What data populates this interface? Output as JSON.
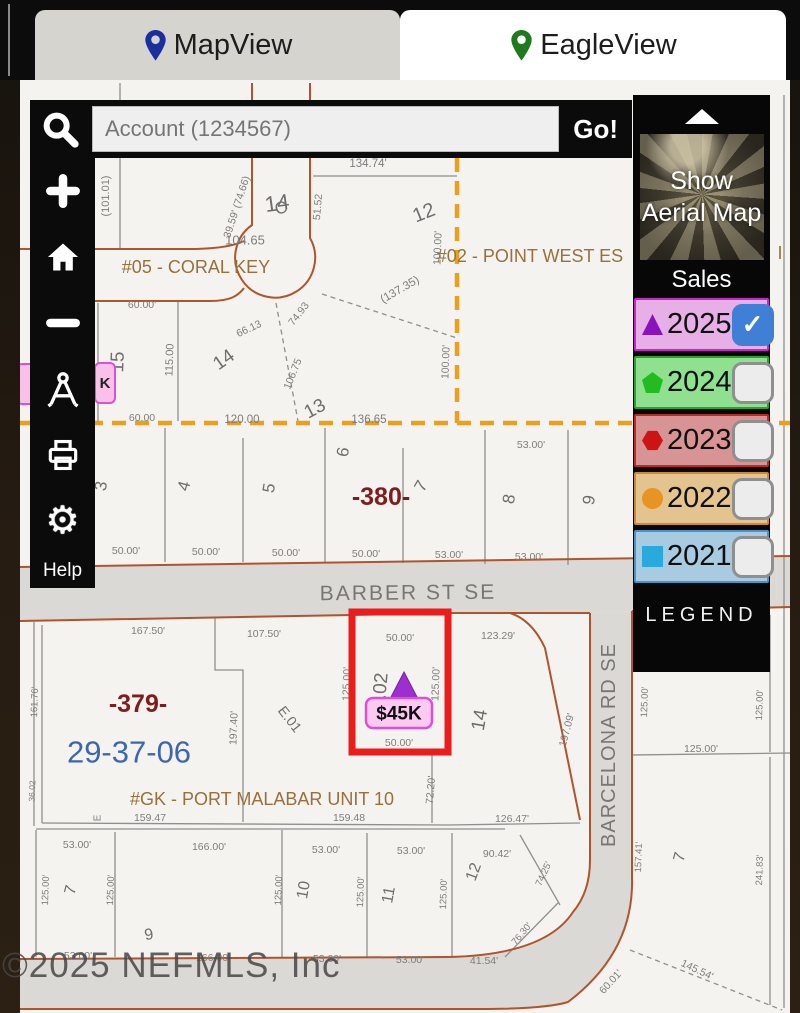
{
  "tabs": {
    "mapview": "MapView",
    "eagleview": "EagleView"
  },
  "search": {
    "placeholder": "Account (1234567)",
    "go": "Go!"
  },
  "toolbar": {
    "help": "Help"
  },
  "icons": {
    "tabs": [
      "map-pin-blue",
      "map-pin-green"
    ],
    "toolbar": [
      "search",
      "zoom-in",
      "home",
      "zoom-out",
      "measure",
      "print",
      "settings"
    ],
    "panel": [
      "collapse-up"
    ]
  },
  "panel": {
    "aerial": "Show Aerial Map",
    "sales": "Sales",
    "legend": "LEGEND",
    "years": [
      {
        "label": "2025",
        "bg": "#e6b0e6",
        "border": "#cc22cc",
        "icon": "triangle",
        "icon_color": "#8812bb",
        "checked": true
      },
      {
        "label": "2024",
        "bg": "#8fe08f",
        "border": "#2f9f2f",
        "icon": "pentagon",
        "icon_color": "#22bb22",
        "checked": false
      },
      {
        "label": "2023",
        "bg": "#d89494",
        "border": "#bb2929",
        "icon": "hexagon",
        "icon_color": "#cc1414",
        "checked": false
      },
      {
        "label": "2022",
        "bg": "#e4c48e",
        "border": "#cc8833",
        "icon": "circle",
        "icon_color": "#e89424",
        "checked": false
      },
      {
        "label": "2021",
        "bg": "#a8cbe2",
        "border": "#4a94c4",
        "icon": "square",
        "icon_color": "#28aadc",
        "checked": false
      }
    ]
  },
  "map": {
    "watermark": "©2025 NEFMLS, Inc",
    "badge": "$45K",
    "hidden_marker": "K",
    "labels": [
      {
        "t": "(101.01)",
        "x": 106,
        "y": 196,
        "r": -90,
        "s": 11,
        "c": "d"
      },
      {
        "t": "14",
        "x": 277,
        "y": 203,
        "r": -8,
        "s": 22,
        "c": "l"
      },
      {
        "t": "104.65",
        "x": 245,
        "y": 240,
        "r": 0,
        "s": 13,
        "c": "d"
      },
      {
        "t": "39.59' (74.66)",
        "x": 237,
        "y": 207,
        "r": -72,
        "s": 10.5,
        "c": "d"
      },
      {
        "t": "C",
        "x": 281,
        "y": 208,
        "r": -15,
        "s": 17,
        "c": "l"
      },
      {
        "t": "134.74'",
        "x": 368,
        "y": 164,
        "r": 0,
        "s": 11.5,
        "c": "d"
      },
      {
        "t": "51.52",
        "x": 318,
        "y": 207,
        "r": -85,
        "s": 10.5,
        "c": "d"
      },
      {
        "t": "12",
        "x": 424,
        "y": 213,
        "r": -22,
        "s": 20,
        "c": "l"
      },
      {
        "t": "(137.35)",
        "x": 400,
        "y": 290,
        "r": -30,
        "s": 11.5,
        "c": "d"
      },
      {
        "t": "100.00'",
        "x": 438,
        "y": 248,
        "r": -88,
        "s": 10.5,
        "c": "d"
      },
      {
        "t": "100.00'",
        "x": 446,
        "y": 362,
        "r": -88,
        "s": 10.5,
        "c": "d"
      },
      {
        "t": "#05 - CORAL KEY",
        "x": 196,
        "y": 267,
        "r": 0,
        "s": 18,
        "c": "b"
      },
      {
        "t": "#02 - POINT WEST ES",
        "x": 530,
        "y": 256,
        "r": 0,
        "s": 18,
        "c": "b"
      },
      {
        "t": "I",
        "x": 780,
        "y": 253,
        "r": 0,
        "s": 18,
        "c": "b"
      },
      {
        "t": "60.00'",
        "x": 142,
        "y": 305,
        "r": 0,
        "s": 10.5,
        "c": "d"
      },
      {
        "t": "15",
        "x": 118,
        "y": 362,
        "r": -88,
        "s": 19,
        "c": "l"
      },
      {
        "t": "115.00",
        "x": 170,
        "y": 360,
        "r": -88,
        "s": 11,
        "c": "d"
      },
      {
        "t": "14",
        "x": 224,
        "y": 360,
        "r": -35,
        "s": 19,
        "c": "l"
      },
      {
        "t": "66.13",
        "x": 249,
        "y": 329,
        "r": -25,
        "s": 10.5,
        "c": "d"
      },
      {
        "t": "74.93",
        "x": 299,
        "y": 314,
        "r": -52,
        "s": 10.5,
        "c": "d"
      },
      {
        "t": "106.75",
        "x": 293,
        "y": 374,
        "r": -68,
        "s": 10.5,
        "c": "d"
      },
      {
        "t": "13",
        "x": 315,
        "y": 409,
        "r": -28,
        "s": 19,
        "c": "l"
      },
      {
        "t": "60.00",
        "x": 142,
        "y": 418,
        "r": 0,
        "s": 10.5,
        "c": "d"
      },
      {
        "t": "120.00",
        "x": 242,
        "y": 420,
        "r": 0,
        "s": 11.5,
        "c": "d"
      },
      {
        "t": "136.65",
        "x": 369,
        "y": 420,
        "r": 0,
        "s": 11.5,
        "c": "d"
      },
      {
        "t": "3",
        "x": 101,
        "y": 486,
        "r": -80,
        "s": 17,
        "c": "l"
      },
      {
        "t": "4",
        "x": 184,
        "y": 486,
        "r": -75,
        "s": 17,
        "c": "l"
      },
      {
        "t": "5",
        "x": 269,
        "y": 488,
        "r": -80,
        "s": 17,
        "c": "l"
      },
      {
        "t": "6",
        "x": 343,
        "y": 452,
        "r": -80,
        "s": 17,
        "c": "l"
      },
      {
        "t": "-380-",
        "x": 381,
        "y": 497,
        "r": 0,
        "s": 25,
        "c": "r"
      },
      {
        "t": "7",
        "x": 421,
        "y": 486,
        "r": -60,
        "s": 17,
        "c": "l"
      },
      {
        "t": "8",
        "x": 509,
        "y": 499,
        "r": -80,
        "s": 17,
        "c": "l"
      },
      {
        "t": "9",
        "x": 589,
        "y": 500,
        "r": -80,
        "s": 17,
        "c": "l"
      },
      {
        "t": "53.00'",
        "x": 531,
        "y": 445,
        "r": 0,
        "s": 10.5,
        "c": "d"
      },
      {
        "t": "50.00'",
        "x": 126,
        "y": 551,
        "r": 0,
        "s": 10.5,
        "c": "d"
      },
      {
        "t": "50.00'",
        "x": 206,
        "y": 552,
        "r": 0,
        "s": 10.5,
        "c": "d"
      },
      {
        "t": "50.00'",
        "x": 286,
        "y": 553,
        "r": 0,
        "s": 10.5,
        "c": "d"
      },
      {
        "t": "50.00'",
        "x": 366,
        "y": 554,
        "r": 0,
        "s": 10.5,
        "c": "d"
      },
      {
        "t": "53.00'",
        "x": 449,
        "y": 555,
        "r": 0,
        "s": 10.5,
        "c": "d"
      },
      {
        "t": "53.00'",
        "x": 529,
        "y": 557,
        "r": 0,
        "s": 10.5,
        "c": "d"
      },
      {
        "t": "BARBER ST SE",
        "x": 408,
        "y": 593,
        "r": -0.5,
        "s": 21,
        "c": "s",
        "ls": 2
      },
      {
        "t": "167.50'",
        "x": 148,
        "y": 631,
        "r": 0,
        "s": 10.5,
        "c": "d"
      },
      {
        "t": "107.50'",
        "x": 264,
        "y": 634,
        "r": 0,
        "s": 10.5,
        "c": "d"
      },
      {
        "t": "50.00'",
        "x": 400,
        "y": 638,
        "r": 0,
        "s": 10.5,
        "c": "d"
      },
      {
        "t": "123.29'",
        "x": 498,
        "y": 636,
        "r": 0,
        "s": 10.5,
        "c": "d"
      },
      {
        "t": "125.00'",
        "x": 347,
        "y": 684,
        "r": -88,
        "s": 10.5,
        "c": "d"
      },
      {
        "t": ".02",
        "x": 381,
        "y": 686,
        "r": -85,
        "s": 19,
        "c": "l"
      },
      {
        "t": "125.00'",
        "x": 436,
        "y": 684,
        "r": -88,
        "s": 10.5,
        "c": "d"
      },
      {
        "t": "50.00'",
        "x": 399,
        "y": 743,
        "r": 0,
        "s": 10.5,
        "c": "d"
      },
      {
        "t": "14",
        "x": 480,
        "y": 720,
        "r": -80,
        "s": 19,
        "c": "l"
      },
      {
        "t": "197.09'",
        "x": 567,
        "y": 730,
        "r": -75,
        "s": 10.5,
        "c": "d"
      },
      {
        "t": "-379-",
        "x": 138,
        "y": 704,
        "r": 0,
        "s": 25,
        "c": "r"
      },
      {
        "t": "29-37-06",
        "x": 129,
        "y": 752,
        "r": 0,
        "s": 31,
        "c": "u"
      },
      {
        "t": "197.40'",
        "x": 234,
        "y": 728,
        "r": -88,
        "s": 10.5,
        "c": "d"
      },
      {
        "t": "E.01",
        "x": 290,
        "y": 719,
        "r": 52,
        "s": 14,
        "c": "l"
      },
      {
        "t": "#GK - PORT MALABAR UNIT 10",
        "x": 262,
        "y": 799,
        "r": 0,
        "s": 18,
        "c": "b"
      },
      {
        "t": "159.47",
        "x": 150,
        "y": 818,
        "r": 0,
        "s": 10.5,
        "c": "d"
      },
      {
        "t": "E",
        "x": 98,
        "y": 818,
        "r": -90,
        "s": 10,
        "c": "d"
      },
      {
        "t": "161.76'",
        "x": 35,
        "y": 702,
        "r": -88,
        "s": 9.5,
        "c": "d"
      },
      {
        "t": "36.02",
        "x": 32,
        "y": 791,
        "r": -88,
        "s": 8.5,
        "c": "d"
      },
      {
        "t": "72.20'",
        "x": 431,
        "y": 790,
        "r": -85,
        "s": 10.5,
        "c": "d"
      },
      {
        "t": "159.48",
        "x": 349,
        "y": 818,
        "r": 0,
        "s": 10.5,
        "c": "d"
      },
      {
        "t": "126.47'",
        "x": 512,
        "y": 819,
        "r": 0,
        "s": 10.5,
        "c": "d"
      },
      {
        "t": "53.00'",
        "x": 77,
        "y": 845,
        "r": 0,
        "s": 10.5,
        "c": "d"
      },
      {
        "t": "166.00'",
        "x": 209,
        "y": 847,
        "r": 0,
        "s": 10.5,
        "c": "d"
      },
      {
        "t": "53.00'",
        "x": 326,
        "y": 850,
        "r": 0,
        "s": 10.5,
        "c": "d"
      },
      {
        "t": "53.00'",
        "x": 411,
        "y": 851,
        "r": 0,
        "s": 10.5,
        "c": "d"
      },
      {
        "t": "90.42'",
        "x": 497,
        "y": 854,
        "r": 0,
        "s": 10.5,
        "c": "d"
      },
      {
        "t": "125.00'",
        "x": 46,
        "y": 890,
        "r": -88,
        "s": 9.5,
        "c": "d"
      },
      {
        "t": "7",
        "x": 71,
        "y": 890,
        "r": -75,
        "s": 16,
        "c": "l"
      },
      {
        "t": "125.00'",
        "x": 111,
        "y": 890,
        "r": -88,
        "s": 9.5,
        "c": "d"
      },
      {
        "t": "9",
        "x": 149,
        "y": 935,
        "r": -10,
        "s": 16,
        "c": "l"
      },
      {
        "t": "125.00'",
        "x": 279,
        "y": 890,
        "r": -88,
        "s": 9.5,
        "c": "d"
      },
      {
        "t": "10",
        "x": 304,
        "y": 890,
        "r": -80,
        "s": 16,
        "c": "l"
      },
      {
        "t": "125.00'",
        "x": 361,
        "y": 892,
        "r": -88,
        "s": 9.5,
        "c": "d"
      },
      {
        "t": "11",
        "x": 389,
        "y": 895,
        "r": -80,
        "s": 16,
        "c": "l"
      },
      {
        "t": "125.00'",
        "x": 444,
        "y": 894,
        "r": -88,
        "s": 9.5,
        "c": "d"
      },
      {
        "t": "12",
        "x": 474,
        "y": 872,
        "r": -70,
        "s": 16,
        "c": "l"
      },
      {
        "t": "74.25'",
        "x": 544,
        "y": 874,
        "r": -65,
        "s": 9.5,
        "c": "d"
      },
      {
        "t": "53.00'",
        "x": 78,
        "y": 956,
        "r": 0,
        "s": 10.5,
        "c": "d"
      },
      {
        "t": "166.00'",
        "x": 213,
        "y": 958,
        "r": 0,
        "s": 10.5,
        "c": "d"
      },
      {
        "t": "53.00'",
        "x": 327,
        "y": 959,
        "r": 0,
        "s": 10.5,
        "c": "d"
      },
      {
        "t": "53.00'",
        "x": 410,
        "y": 960,
        "r": 0,
        "s": 10.5,
        "c": "d"
      },
      {
        "t": "41.54'",
        "x": 484,
        "y": 961,
        "r": 0,
        "s": 10.5,
        "c": "d"
      },
      {
        "t": "76.30'",
        "x": 522,
        "y": 934,
        "r": -50,
        "s": 9.5,
        "c": "d"
      },
      {
        "t": "BARCELONA RD SE",
        "x": 609,
        "y": 745,
        "r": -90,
        "s": 20,
        "c": "s",
        "ls": 1
      },
      {
        "t": "157.41'",
        "x": 639,
        "y": 857,
        "r": -88,
        "s": 9.5,
        "c": "d"
      },
      {
        "t": "7",
        "x": 680,
        "y": 857,
        "r": -75,
        "s": 16,
        "c": "l"
      },
      {
        "t": "241.83'",
        "x": 760,
        "y": 870,
        "r": -88,
        "s": 9.5,
        "c": "d"
      },
      {
        "t": "125.00'",
        "x": 645,
        "y": 702,
        "r": -88,
        "s": 9.5,
        "c": "d"
      },
      {
        "t": "125.00'",
        "x": 760,
        "y": 705,
        "r": -88,
        "s": 9.5,
        "c": "d"
      },
      {
        "t": "125.00'",
        "x": 701,
        "y": 749,
        "r": 0,
        "s": 10.5,
        "c": "d"
      },
      {
        "t": "60.01'",
        "x": 611,
        "y": 982,
        "r": -48,
        "s": 10.5,
        "c": "d"
      },
      {
        "t": "145.54'",
        "x": 697,
        "y": 970,
        "r": 25,
        "s": 10.5,
        "c": "d"
      }
    ]
  }
}
